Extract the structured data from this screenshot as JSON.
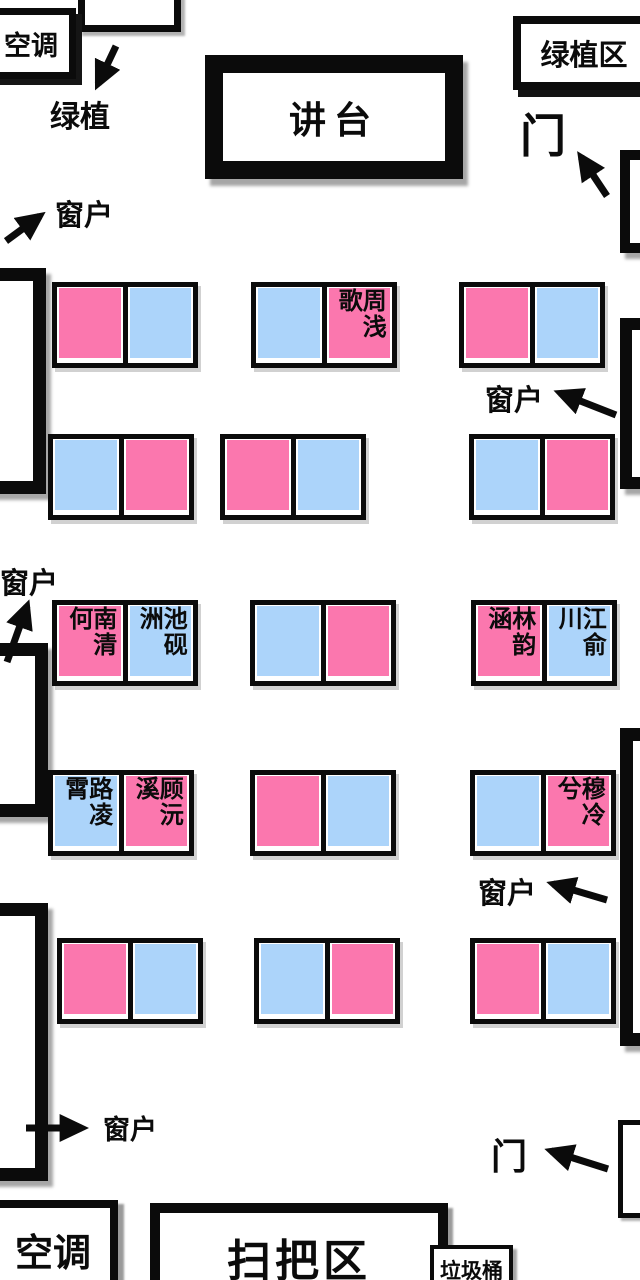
{
  "colors": {
    "pink": "#FB77AE",
    "blue": "#ACD4FA",
    "outline": "#0b0b0b"
  },
  "zones": {
    "ac": "空调",
    "podium": "讲台",
    "greenery_area": "绿植区",
    "broom_area": "扫把区",
    "trash_bin": "垃圾桶"
  },
  "annotations": {
    "greenery": "绿植",
    "window": "窗户",
    "door": "门"
  },
  "desks": [
    {
      "row": 1,
      "col": 1,
      "seats": [
        {
          "color": "pink",
          "name": ""
        },
        {
          "color": "blue",
          "name": ""
        }
      ]
    },
    {
      "row": 1,
      "col": 2,
      "seats": [
        {
          "color": "blue",
          "name": ""
        },
        {
          "color": "pink",
          "name": "周浅歌"
        }
      ]
    },
    {
      "row": 1,
      "col": 3,
      "seats": [
        {
          "color": "pink",
          "name": ""
        },
        {
          "color": "blue",
          "name": ""
        }
      ]
    },
    {
      "row": 2,
      "col": 1,
      "seats": [
        {
          "color": "blue",
          "name": ""
        },
        {
          "color": "pink",
          "name": ""
        }
      ]
    },
    {
      "row": 2,
      "col": 2,
      "seats": [
        {
          "color": "pink",
          "name": ""
        },
        {
          "color": "blue",
          "name": ""
        }
      ]
    },
    {
      "row": 2,
      "col": 3,
      "seats": [
        {
          "color": "blue",
          "name": ""
        },
        {
          "color": "pink",
          "name": ""
        }
      ]
    },
    {
      "row": 3,
      "col": 1,
      "seats": [
        {
          "color": "pink",
          "name": "南清何"
        },
        {
          "color": "blue",
          "name": "池砚洲"
        }
      ]
    },
    {
      "row": 3,
      "col": 2,
      "seats": [
        {
          "color": "blue",
          "name": ""
        },
        {
          "color": "pink",
          "name": ""
        }
      ]
    },
    {
      "row": 3,
      "col": 3,
      "seats": [
        {
          "color": "pink",
          "name": "林韵涵"
        },
        {
          "color": "blue",
          "name": "江俞川"
        }
      ]
    },
    {
      "row": 4,
      "col": 1,
      "seats": [
        {
          "color": "blue",
          "name": "路凌霄"
        },
        {
          "color": "pink",
          "name": "顾沅溪"
        }
      ]
    },
    {
      "row": 4,
      "col": 2,
      "seats": [
        {
          "color": "pink",
          "name": ""
        },
        {
          "color": "blue",
          "name": ""
        }
      ]
    },
    {
      "row": 4,
      "col": 3,
      "seats": [
        {
          "color": "blue",
          "name": ""
        },
        {
          "color": "pink",
          "name": "穆冷兮"
        }
      ]
    },
    {
      "row": 5,
      "col": 1,
      "seats": [
        {
          "color": "pink",
          "name": ""
        },
        {
          "color": "blue",
          "name": ""
        }
      ]
    },
    {
      "row": 5,
      "col": 2,
      "seats": [
        {
          "color": "blue",
          "name": ""
        },
        {
          "color": "pink",
          "name": ""
        }
      ]
    },
    {
      "row": 5,
      "col": 3,
      "seats": [
        {
          "color": "pink",
          "name": ""
        },
        {
          "color": "blue",
          "name": ""
        }
      ]
    }
  ]
}
